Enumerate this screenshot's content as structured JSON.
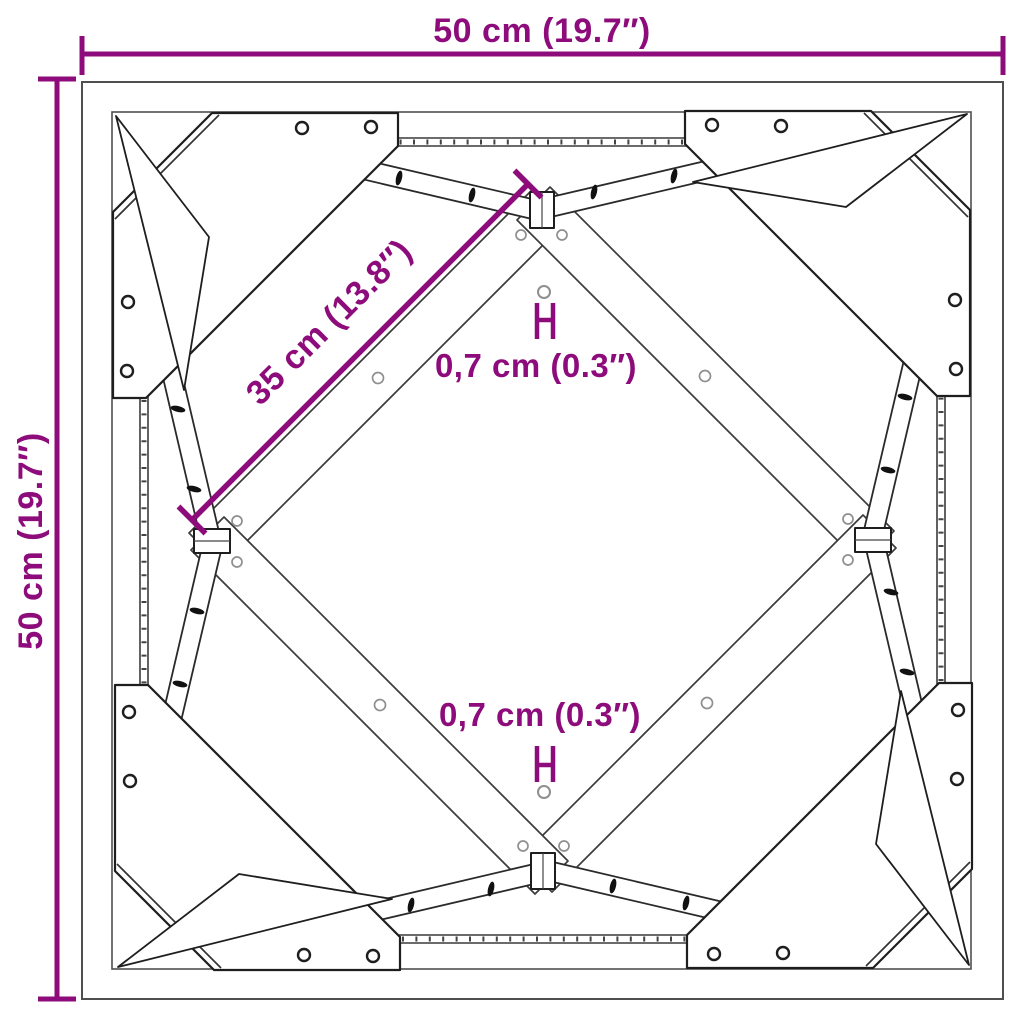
{
  "page": {
    "background": "#ffffff",
    "subject": "Square table frame underside dimension diagram with corner gusset plates and diagonal cross braces"
  },
  "labels": {
    "width": "50 cm (19.7″)",
    "height": "50 cm (19.7″)",
    "diagonal": "35 cm (13.8″)",
    "hole_top": "0,7 cm (0.3″)",
    "hole_bottom": "0,7 cm (0.3″)"
  },
  "colors": {
    "dimension_accent": "#8d0b7a",
    "linework_dark": "#1e1e1e",
    "frame_gray": "#4f4f4f",
    "hole_outline_gray": "#8f8f8f",
    "background": "#ffffff"
  },
  "icons": {
    "hole_marker_top": "hole-diameter-marker",
    "hole_marker_bottom": "hole-diameter-marker"
  }
}
